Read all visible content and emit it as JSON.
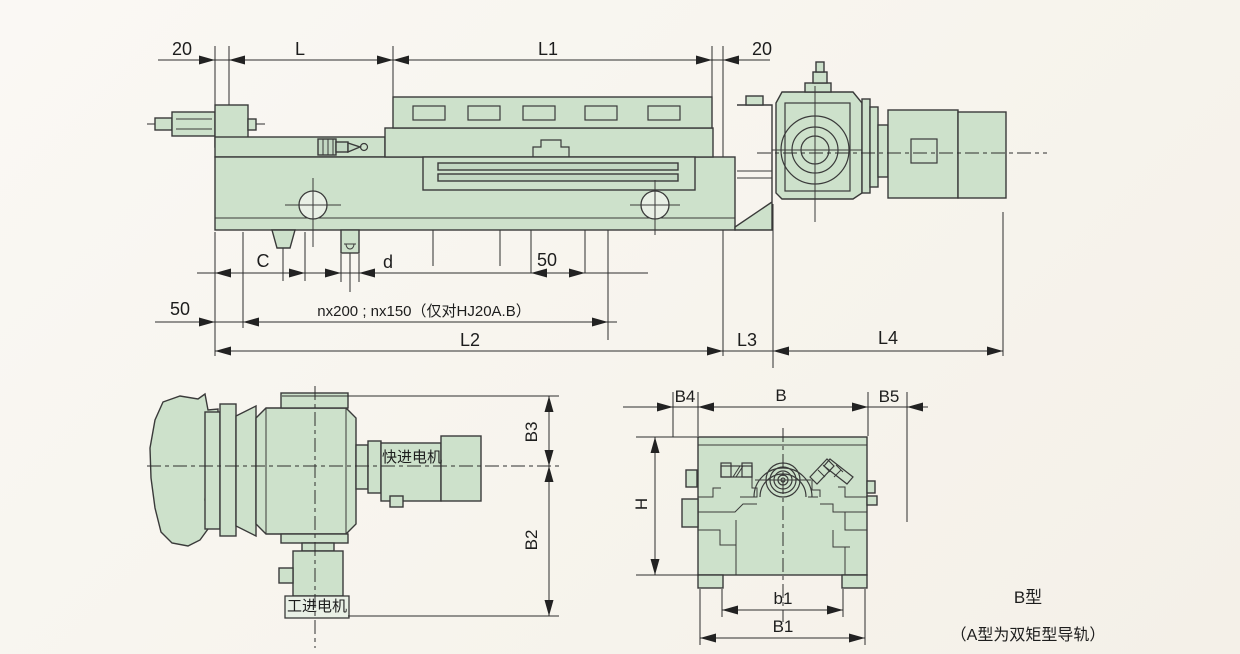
{
  "drawing": {
    "kind": "machine-slide-unit-outline-drawing",
    "colors": {
      "part_fill": "#cde1cb",
      "part_fill_dark": "#c3d8c3",
      "line": "#3a3a3a",
      "background": "#f7f4ed"
    }
  },
  "main_view": {
    "top_dims": {
      "left_20": "20",
      "L": "L",
      "L1": "L1",
      "right_20": "20"
    },
    "bottom_dims": {
      "C": "C",
      "d": "d",
      "top_50": "50",
      "left_50": "50",
      "pitch": "nx200 ; nx150（仅对HJ20A.B）",
      "L2": "L2",
      "L3": "L3",
      "L4": "L4"
    }
  },
  "motor_view": {
    "rapid_motor_label": "快进电机",
    "work_motor_label": "工进电机",
    "dims": {
      "B3": "B3",
      "B2": "B2"
    }
  },
  "section_view": {
    "dims": {
      "B4": "B4",
      "B": "B",
      "B5": "B5",
      "H": "H",
      "b1": "b1",
      "B1": "B1"
    },
    "type_label": "B型",
    "type_note": "（A型为双矩型导轨）"
  }
}
